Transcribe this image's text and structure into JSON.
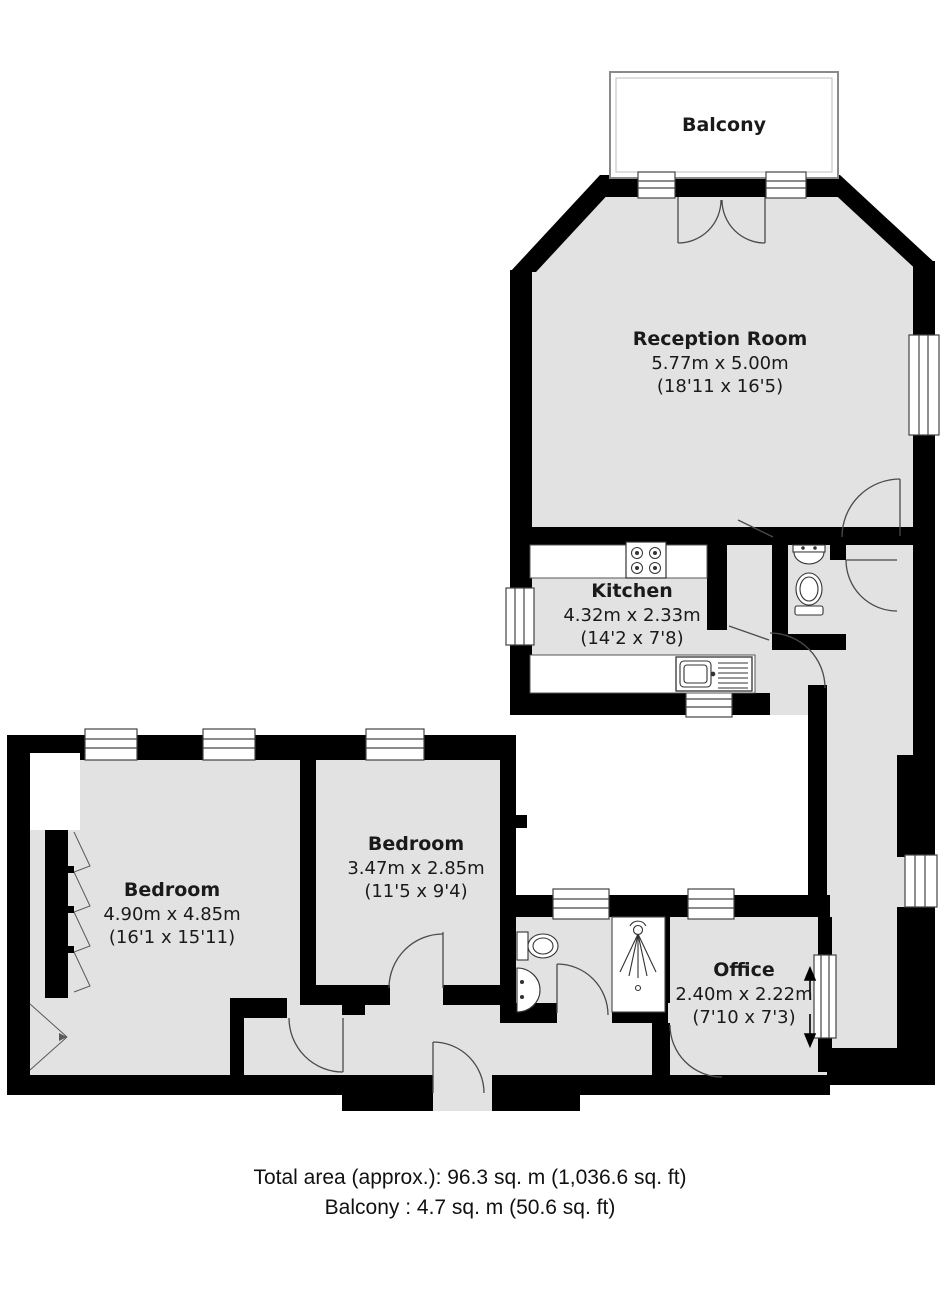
{
  "balcony": {
    "label": "Balcony"
  },
  "rooms": [
    {
      "name": "Reception Room",
      "dims_m": "5.77m x 5.00m",
      "dims_ft": "(18'11 x 16'5)"
    },
    {
      "name": "Kitchen",
      "dims_m": "4.32m x 2.33m",
      "dims_ft": "(14'2 x 7'8)"
    },
    {
      "name": "Bedroom",
      "dims_m": "4.90m x 4.85m",
      "dims_ft": "(16'1 x 15'11)"
    },
    {
      "name": "Bedroom",
      "dims_m": "3.47m x 2.85m",
      "dims_ft": "(11'5 x 9'4)"
    },
    {
      "name": "Office",
      "dims_m": "2.40m x 2.22m",
      "dims_ft": "(7'10 x 7'3)"
    }
  ],
  "footer": {
    "total_area": "Total area (approx.): 96.3 sq. m (1,036.6 sq. ft)",
    "balcony_area": "Balcony : 4.7 sq. m (50.6 sq. ft)"
  },
  "colors": {
    "floor": "#e2e2e2",
    "wall": "#000000",
    "line": "#4a4a4a"
  }
}
